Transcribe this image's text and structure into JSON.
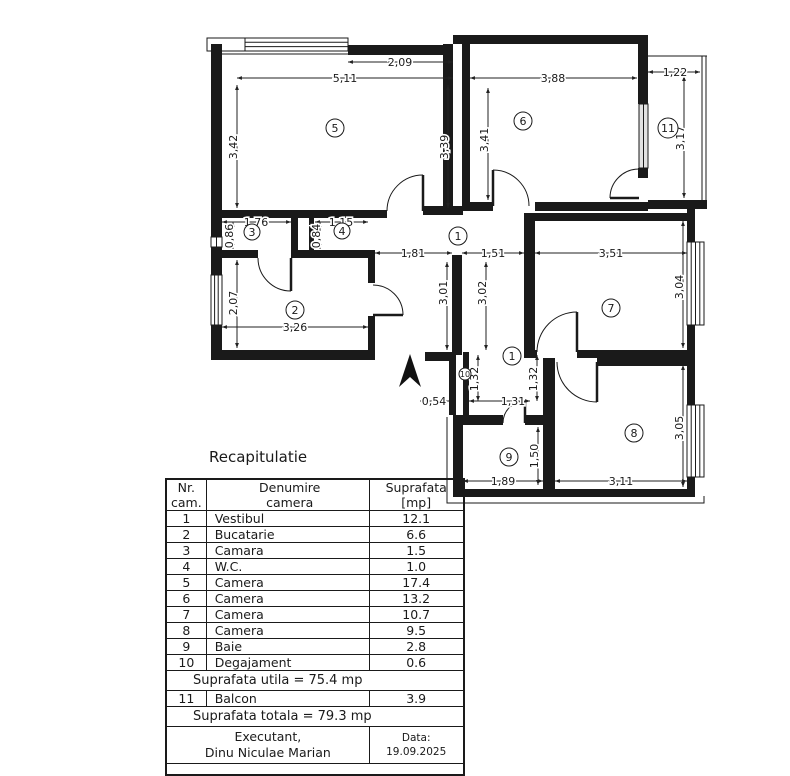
{
  "plan": {
    "dims": {
      "d511": "5,11",
      "d209": "2,09",
      "d388": "3,88",
      "d122": "1,22",
      "d342": "3,42",
      "d339": "3,39",
      "d341": "3,41",
      "d317": "3,17",
      "d176": "1,76",
      "d086": "0,86",
      "d115": "1,15",
      "d084": "0,84",
      "d181": "1,81",
      "d151": "1,51",
      "d351": "3,51",
      "d301": "3,01",
      "d302": "3,02",
      "d304": "3,04",
      "d207": "2,07",
      "d326": "3,26",
      "d054": "0,54",
      "d131": "1,31",
      "d132a": "1,32",
      "d132b": "1,32",
      "d189": "1,89",
      "d150": "1,50",
      "d311": "3,11",
      "d305": "3,05"
    },
    "rooms": {
      "r1a": "1",
      "r1b": "1",
      "r2": "2",
      "r3": "3",
      "r4": "4",
      "r5": "5",
      "r6": "6",
      "r7": "7",
      "r8": "8",
      "r9": "9",
      "r10": "10",
      "r11": "11"
    }
  },
  "recap": {
    "title": "Recapitulatie",
    "header": {
      "nr1": "Nr.",
      "nr2": "cam.",
      "name1": "Denumire",
      "name2": "camera",
      "area1": "Suprafata",
      "area2": "[mp]"
    },
    "rows": [
      {
        "nr": "1",
        "name": "Vestibul",
        "area": "12.1"
      },
      {
        "nr": "2",
        "name": "Bucatarie",
        "area": "6.6"
      },
      {
        "nr": "3",
        "name": "Camara",
        "area": "1.5"
      },
      {
        "nr": "4",
        "name": "W.C.",
        "area": "1.0"
      },
      {
        "nr": "5",
        "name": "Camera",
        "area": "17.4"
      },
      {
        "nr": "6",
        "name": "Camera",
        "area": "13.2"
      },
      {
        "nr": "7",
        "name": "Camera",
        "area": "10.7"
      },
      {
        "nr": "8",
        "name": "Camera",
        "area": "9.5"
      },
      {
        "nr": "9",
        "name": "Baie",
        "area": "2.8"
      },
      {
        "nr": "10",
        "name": "Degajament",
        "area": "0.6"
      }
    ],
    "utila": "Suprafata utila = 75.4 mp",
    "balcon": {
      "nr": "11",
      "name": "Balcon",
      "area": "3.9"
    },
    "totala": "Suprafata totala = 79.3 mp",
    "footer": {
      "role": "Executant,",
      "name": "Dinu Niculae Marian",
      "date_label": "Data:",
      "date_value": "19.09.2025"
    }
  }
}
